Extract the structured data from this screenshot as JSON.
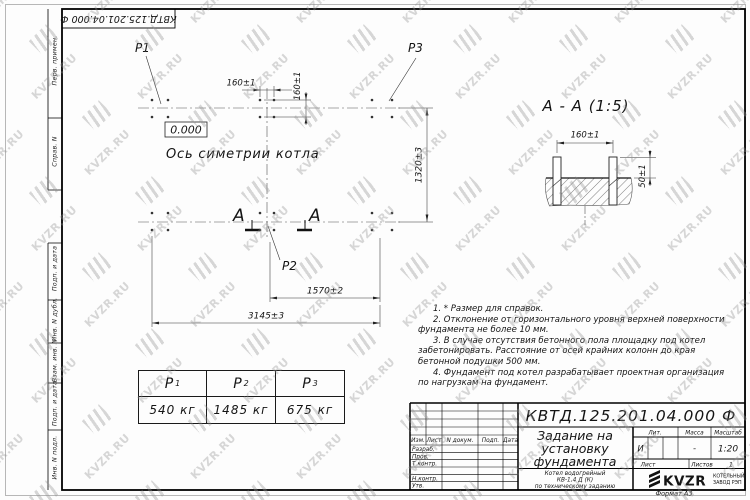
{
  "corner_stamp": {
    "doc_number": "КВТД.125.201.04.000  Ф"
  },
  "side_column": {
    "labels": [
      "Перв. примен.",
      "Справ. N",
      "Подп. и дата",
      "Инв. N дубл.",
      "Взам. инв. N",
      "Подп. и дата",
      "Инв. N подл."
    ]
  },
  "plan": {
    "point_labels": {
      "p1": "P1",
      "p2": "P2",
      "p3": "P3"
    },
    "elevation_mark": "0.000",
    "axis_label": "Ось симетрии котла",
    "section_letter": "А",
    "dim_bolt_pitch_h": "160±1",
    "dim_bolt_pitch_v": "160±1",
    "dim_width": "1320±3",
    "dim_span_inner": "1570±2",
    "dim_length_total": "3145±3"
  },
  "section_view": {
    "title": "А - А (1:5)",
    "dim_bolt_pitch": "160±1",
    "dim_protrusion": "50±1"
  },
  "notes": [
    "1. * Размер для справок.",
    "2. Отклонение от горизонтального уровня верхней поверхности фундамента не более 10 мм.",
    "3. В случае отсутствия бетонного пола площадку под котел забетонировать. Расстояние от осей крайних колонн до края бетонной подушки 500 мм.",
    "4. Фундамент под котел разрабатывает проектная организация по нагрузкам на фундамент."
  ],
  "load_table": {
    "columns": [
      {
        "name": "P",
        "index": "1",
        "value": "540 кг"
      },
      {
        "name": "P",
        "index": "2",
        "value": "1485 кг"
      },
      {
        "name": "P",
        "index": "3",
        "value": "675 кг"
      }
    ]
  },
  "title_block": {
    "doc_number": "КВТД.125.201.04.000  Ф",
    "title_lines": [
      "Задание на",
      "установку",
      "фундамента"
    ],
    "subtitle_lines": [
      "Котел водогрейный",
      "КВ-1,4  Д (К)",
      "по техническому заданию"
    ],
    "header_cols": [
      "Изм.",
      "Лист",
      "N докум.",
      "Подп.",
      "Дата"
    ],
    "row_labels": [
      "Разраб.",
      "Пров.",
      "Т.контр.",
      "Н.контр.",
      "Утв."
    ],
    "lit_label": "Лит.",
    "mass_label": "Масса",
    "scale_label": "Масштаб",
    "lit_value": "И",
    "mass_value": "-",
    "scale_value": "1:20",
    "sheet_label": "Лист",
    "sheets_label": "Листов",
    "sheets_value": "1",
    "logo_text": "KVZR",
    "company_lines": [
      "КОТЕЛЬНЫЙ",
      "ЗАВОД РЭП"
    ],
    "format": "Формат А3"
  },
  "watermark": {
    "text": "KVZR.RU"
  }
}
